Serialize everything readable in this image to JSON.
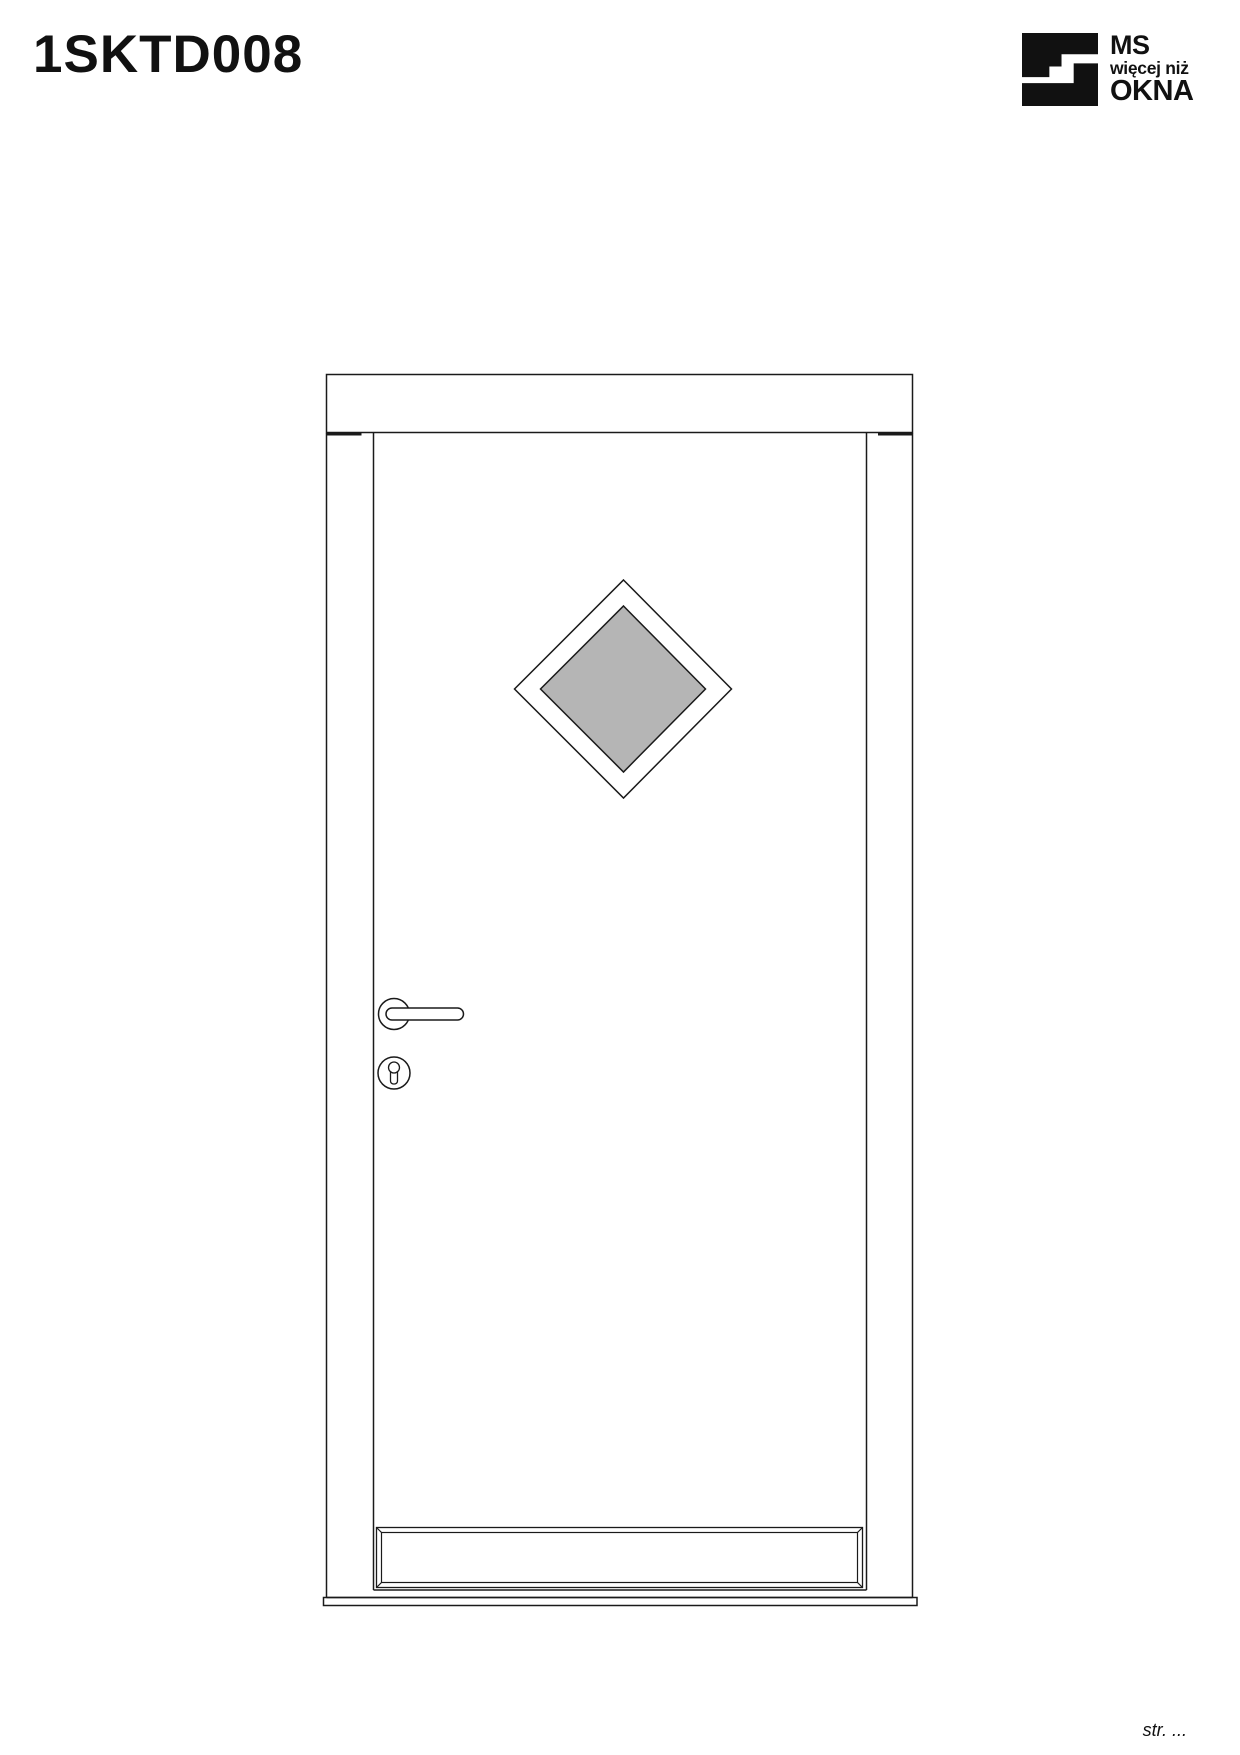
{
  "page": {
    "title": "1SKTD008",
    "footer_page_label": "str. ..."
  },
  "logo": {
    "line1": "MS",
    "line2": "więcej niż",
    "line3": "OKNA",
    "color": "#111111"
  },
  "drawing": {
    "subject": "entry-door-front-view-with-diamond-glazing",
    "line_color": "#1a1a1a",
    "glass_color": "#b5b5b5",
    "fill_color": "#ffffff"
  }
}
